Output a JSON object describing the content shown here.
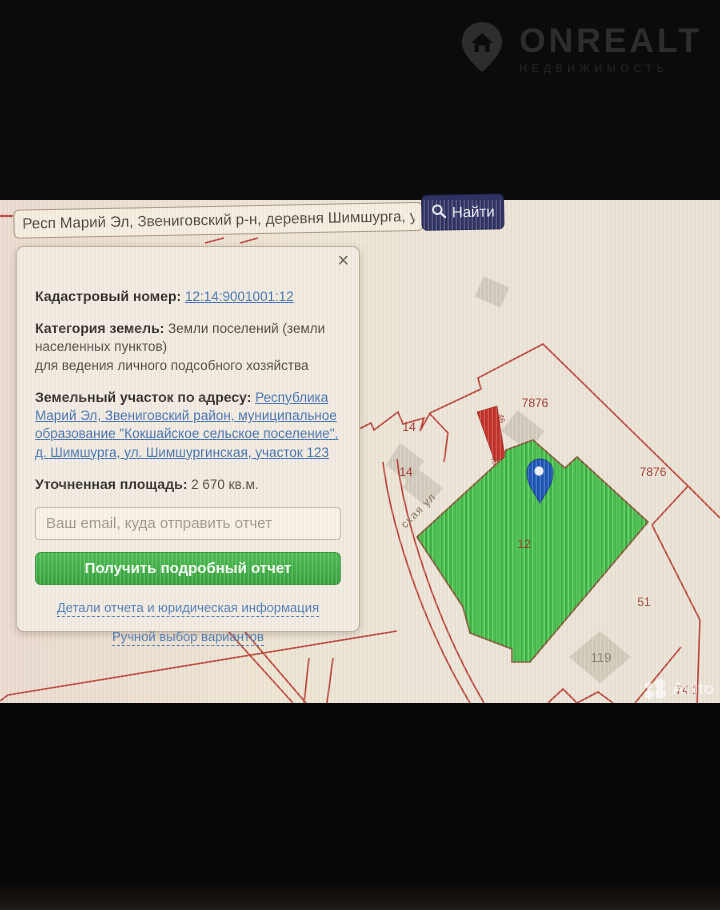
{
  "logo": {
    "title": "ONREALT",
    "subtitle": "НЕДВИЖИМОСТЬ"
  },
  "search": {
    "value": "Респ Марий Эл, Звениговский р-н, деревня Шимшурга, ул Ш",
    "button_label": "Найти"
  },
  "panel": {
    "close_icon": "×",
    "cadastral": {
      "label": "Кадастровый номер:",
      "value": "12:14:9001001:12"
    },
    "category": {
      "label": "Категория земель:",
      "value": "Земли поселений (земли населенных пунктов)",
      "extra": "для ведения личного подсобного хозяйства"
    },
    "address": {
      "label": "Земельный участок по адресу:",
      "value": "Республика Марий Эл, Звениговский район, муниципальное образование \"Кокшайское сельское поселение\", д. Шимшурга, ул. Шимшургинская, участок 123"
    },
    "area": {
      "label": "Уточненная площадь:",
      "value": "2 670 кв.м."
    },
    "email_placeholder": "Ваш email, куда отправить отчет",
    "report_button": "Получить подробный отчет",
    "link_details": "Детали отчета и юридическая информация",
    "link_manual": "Ручной выбор вариантов"
  },
  "map": {
    "labels": {
      "l7876a": "7876",
      "l7876b": "7876",
      "l14a": "14",
      "l14b": "14",
      "l12": "12",
      "l51": "51",
      "l119": "119",
      "l74": "74/1",
      "l46a": "46",
      "l46b": "46",
      "street": "ская ул"
    }
  },
  "watermark": {
    "text": "Avito"
  },
  "colors": {
    "boundary_red": "#b5362c",
    "selected_parcel_green": "#49c24f",
    "pin_blue": "#1d55b5",
    "find_button_navy": "#2e3263",
    "report_button_green": "#3aa741",
    "link_blue": "#3f6fae"
  }
}
